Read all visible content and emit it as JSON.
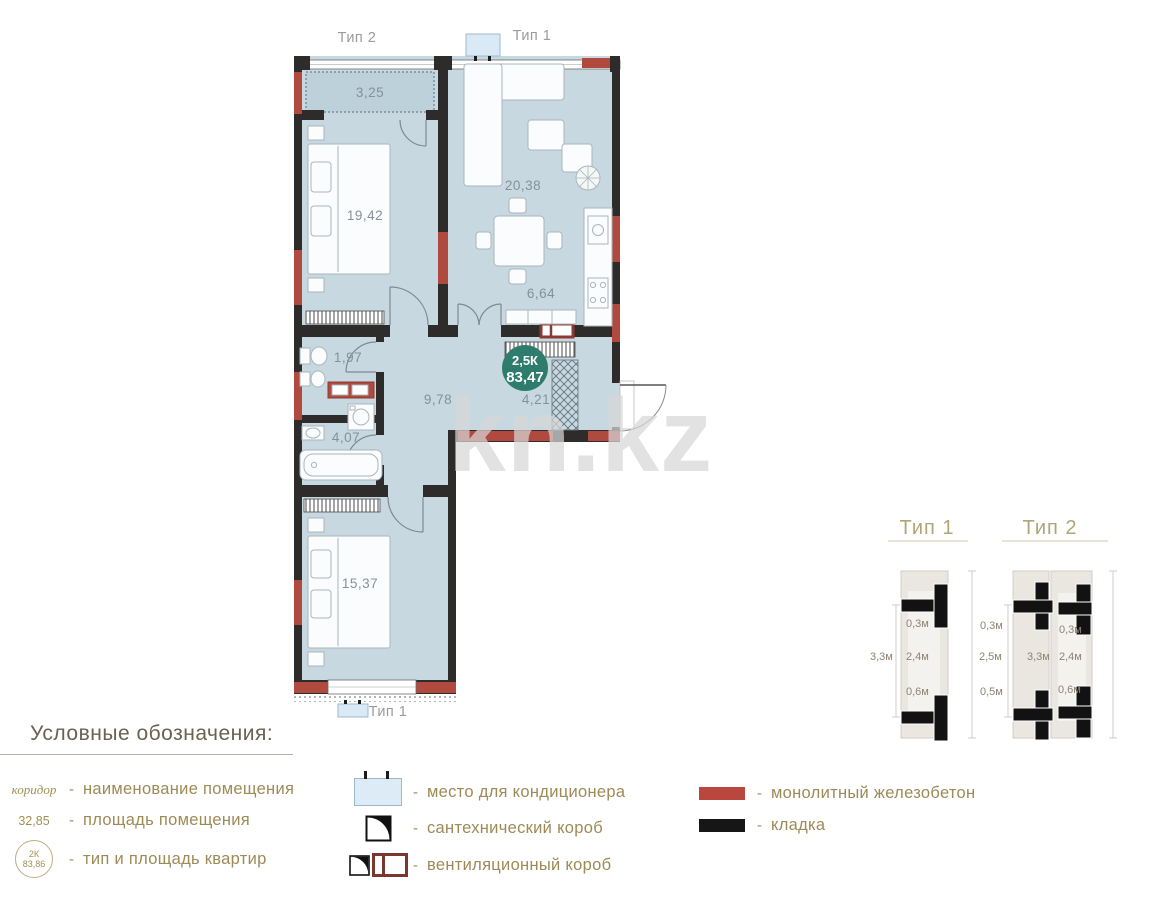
{
  "watermark": {
    "text": "kn.kz"
  },
  "plan": {
    "label_top_left": "Тип 2",
    "label_top_right": "Тип 1",
    "label_bottom": "Тип 1",
    "badge": {
      "type": "2,5К",
      "area": "83,47"
    },
    "rooms": [
      {
        "id": "balcony",
        "area": "3,25"
      },
      {
        "id": "bedroom-1",
        "area": "19,42"
      },
      {
        "id": "living-room",
        "area": "20,38"
      },
      {
        "id": "kitchen",
        "area": "6,64"
      },
      {
        "id": "wc",
        "area": "1,97"
      },
      {
        "id": "hallway",
        "area": "9,78"
      },
      {
        "id": "wardrobe",
        "area": "4,21"
      },
      {
        "id": "bathroom",
        "area": "4,07"
      },
      {
        "id": "bedroom-2",
        "area": "15,37"
      }
    ]
  },
  "diagrams": {
    "type1": {
      "title": "Тип 1",
      "dims": {
        "overall": "3,3м",
        "top": "0,3м",
        "middle": "2,4м",
        "bottom": "0,6м"
      }
    },
    "type2": {
      "title": "Тип 2",
      "dims": {
        "left_top": "0,3м",
        "right_top": "0,3м",
        "left_middle": "2,5м",
        "middle": "3,3м",
        "right_middle": "2,4м",
        "left_bottom": "0,5м",
        "right_bottom": "0,6м"
      }
    }
  },
  "legend": {
    "title": "Условные обозначения:",
    "dash": "-",
    "name_row": {
      "symbol": "коридор",
      "label": "наименование помещения"
    },
    "area_row": {
      "symbol": "32,85",
      "label": "площадь помещения"
    },
    "type_row": {
      "symbol_type": "2К",
      "symbol_area": "83,86",
      "label": "тип и площадь квартир"
    },
    "ac_row": {
      "label": "место для кондиционера"
    },
    "plumb_row": {
      "label": "сантехнический короб"
    },
    "vent_row": {
      "label": "вентиляционный короб"
    },
    "concrete_row": {
      "label": "монолитный железобетон"
    },
    "masonry_row": {
      "label": "кладка"
    }
  },
  "colors": {
    "wall": "#2d2c2a",
    "concrete_red": "#b04a3e",
    "floor": "#c7d8e1",
    "badge_teal": "#2e7d6c",
    "legend_gold": "#9d8a57"
  }
}
